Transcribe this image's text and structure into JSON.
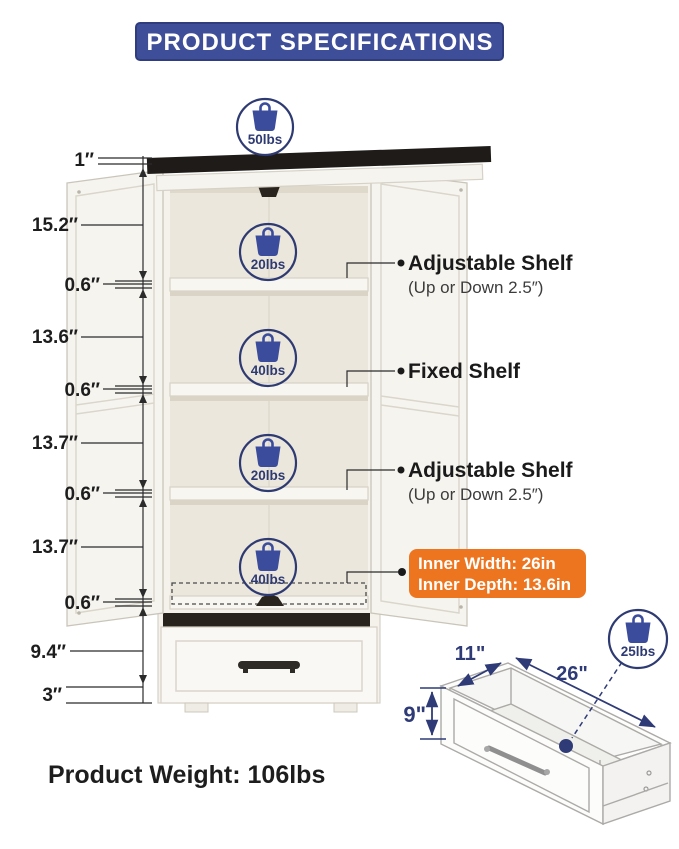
{
  "title": "PRODUCT SPECIFICATIONS",
  "colors": {
    "banner_blue": "#3F4E99",
    "banner_border": "#2F3C7E",
    "badge_navy": "#2E3A72",
    "icon_blue": "#3A4C9B",
    "accent_orange": "#EE7520",
    "cabinet_top_black": "#1E1B18",
    "text_dark": "#1D1D1D"
  },
  "left_dims": [
    "1″",
    "15.2″",
    "0.6″",
    "13.6″",
    "0.6″",
    "13.7″",
    "0.6″",
    "13.7″",
    "0.6″",
    "9.4″",
    "3″"
  ],
  "badges": {
    "top": "50lbs",
    "shelf1": "20lbs",
    "shelf2": "40lbs",
    "shelf3": "20lbs",
    "shelf4": "40lbs",
    "drawer": "25lbs"
  },
  "shelf_labels": [
    {
      "title": "Adjustable Shelf",
      "subtitle": "(Up or Down 2.5″)"
    },
    {
      "title": "Fixed Shelf",
      "subtitle": ""
    },
    {
      "title": "Adjustable Shelf",
      "subtitle": "(Up or Down 2.5″)"
    }
  ],
  "inner_dims": {
    "width_line": "Inner Width: 26in",
    "depth_line": "Inner Depth: 13.6in"
  },
  "drawer_detail": {
    "depth": "11\"",
    "width": "26\"",
    "height": "9\""
  },
  "footer": {
    "product_weight": "Product Weight: 106lbs"
  }
}
